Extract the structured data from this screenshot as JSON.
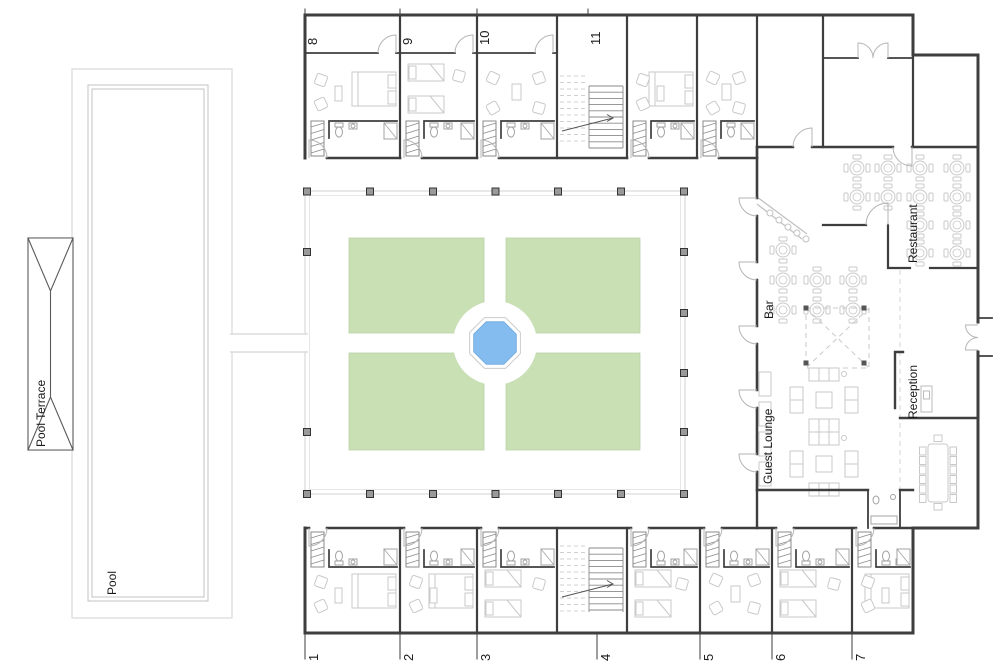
{
  "plan": {
    "areas": {
      "pool": "Pool",
      "pool_terrace": "Pool Terrace",
      "restaurant": "Restaurant",
      "bar": "Bar",
      "reception": "Reception",
      "guest_lounge": "Guest Lounge"
    },
    "rooms_top": [
      "8",
      "9",
      "10",
      "11"
    ],
    "rooms_bottom": [
      "1",
      "2",
      "3",
      "4",
      "5",
      "6",
      "7"
    ],
    "colors": {
      "wall": "#3e3e3e",
      "furniture": "#c9c9c9",
      "fixture": "#a3a3a3",
      "door": "#b5b5b5",
      "garden": "#c9dfb4",
      "garden_edge": "#b9d3a6",
      "water": "#85bcf0",
      "water_edge": "#79aede",
      "light_line": "#d9d9d9",
      "column_fill": "#9a9a9a",
      "stair_dash": "#d0d0d0",
      "text": "#1a1a1a"
    }
  }
}
